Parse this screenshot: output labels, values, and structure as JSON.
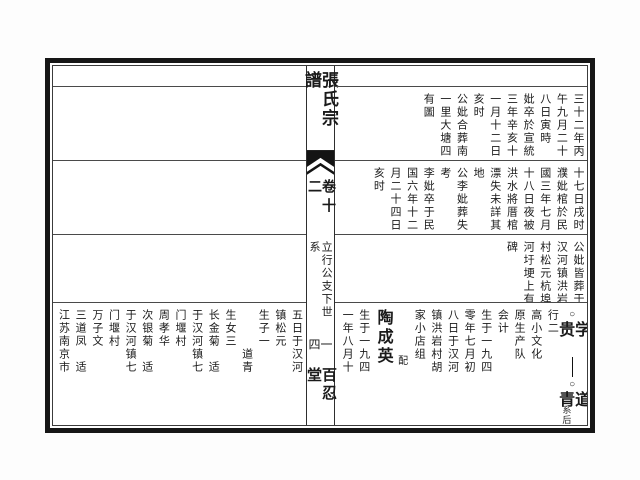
{
  "spine": {
    "title": "張氏宗譜",
    "volume": "卷十二",
    "section": "立行公支下世系",
    "folio": "一四",
    "hall": "百忍堂"
  },
  "right_page": {
    "register1_columns": [
      "三十二年丙",
      "午九月二十",
      "八日寅時",
      "妣卒於宣統",
      "三年辛亥十",
      "一月十二日",
      "亥时",
      "公妣合葬南",
      "一里大塘四",
      "有圖"
    ],
    "register2_columns": [
      "十七日戌时",
      "濮妣棺於民",
      "國三年七月",
      "十八日夜被",
      "洪水將厝棺",
      "漂失未詳其",
      "地",
      "公李妣葬失",
      "考",
      "李妣卒于民",
      "国六年十二",
      "月二十四日",
      "亥时"
    ],
    "register3_columns": [
      "公妣皆葬于",
      "汉河镇洪岩",
      "村松元杭埠",
      "河圩埂上有",
      "碑"
    ],
    "register4": {
      "lineage": {
        "circle_top": "○",
        "parent_name": "学贵",
        "circle_bottom": "○",
        "child_name": "道青",
        "note": "系后"
      },
      "info_columns": [
        "行二",
        "高小文化",
        "原生产队",
        "会计",
        "生于一九四",
        "零年七月初",
        "八日于汉河",
        "镇洪岩村胡",
        "家小店组"
      ],
      "spouse_label": "配",
      "spouse_name": "陶成英",
      "spouse_birth_columns": [
        "生于一九四",
        "一年八月十"
      ]
    }
  },
  "left_page": {
    "register4_columns": [
      "五日于汉河",
      "镇松元",
      "生子一",
      "　　　道青",
      "生女三",
      "长金菊　适",
      "于汉河镇七",
      "门堰村",
      "周孝华",
      "次银菊　适",
      "于汉河镇七",
      "门堰村",
      "万子文",
      "三道凤　适",
      "江苏南京市",
      "下关区"
    ]
  }
}
